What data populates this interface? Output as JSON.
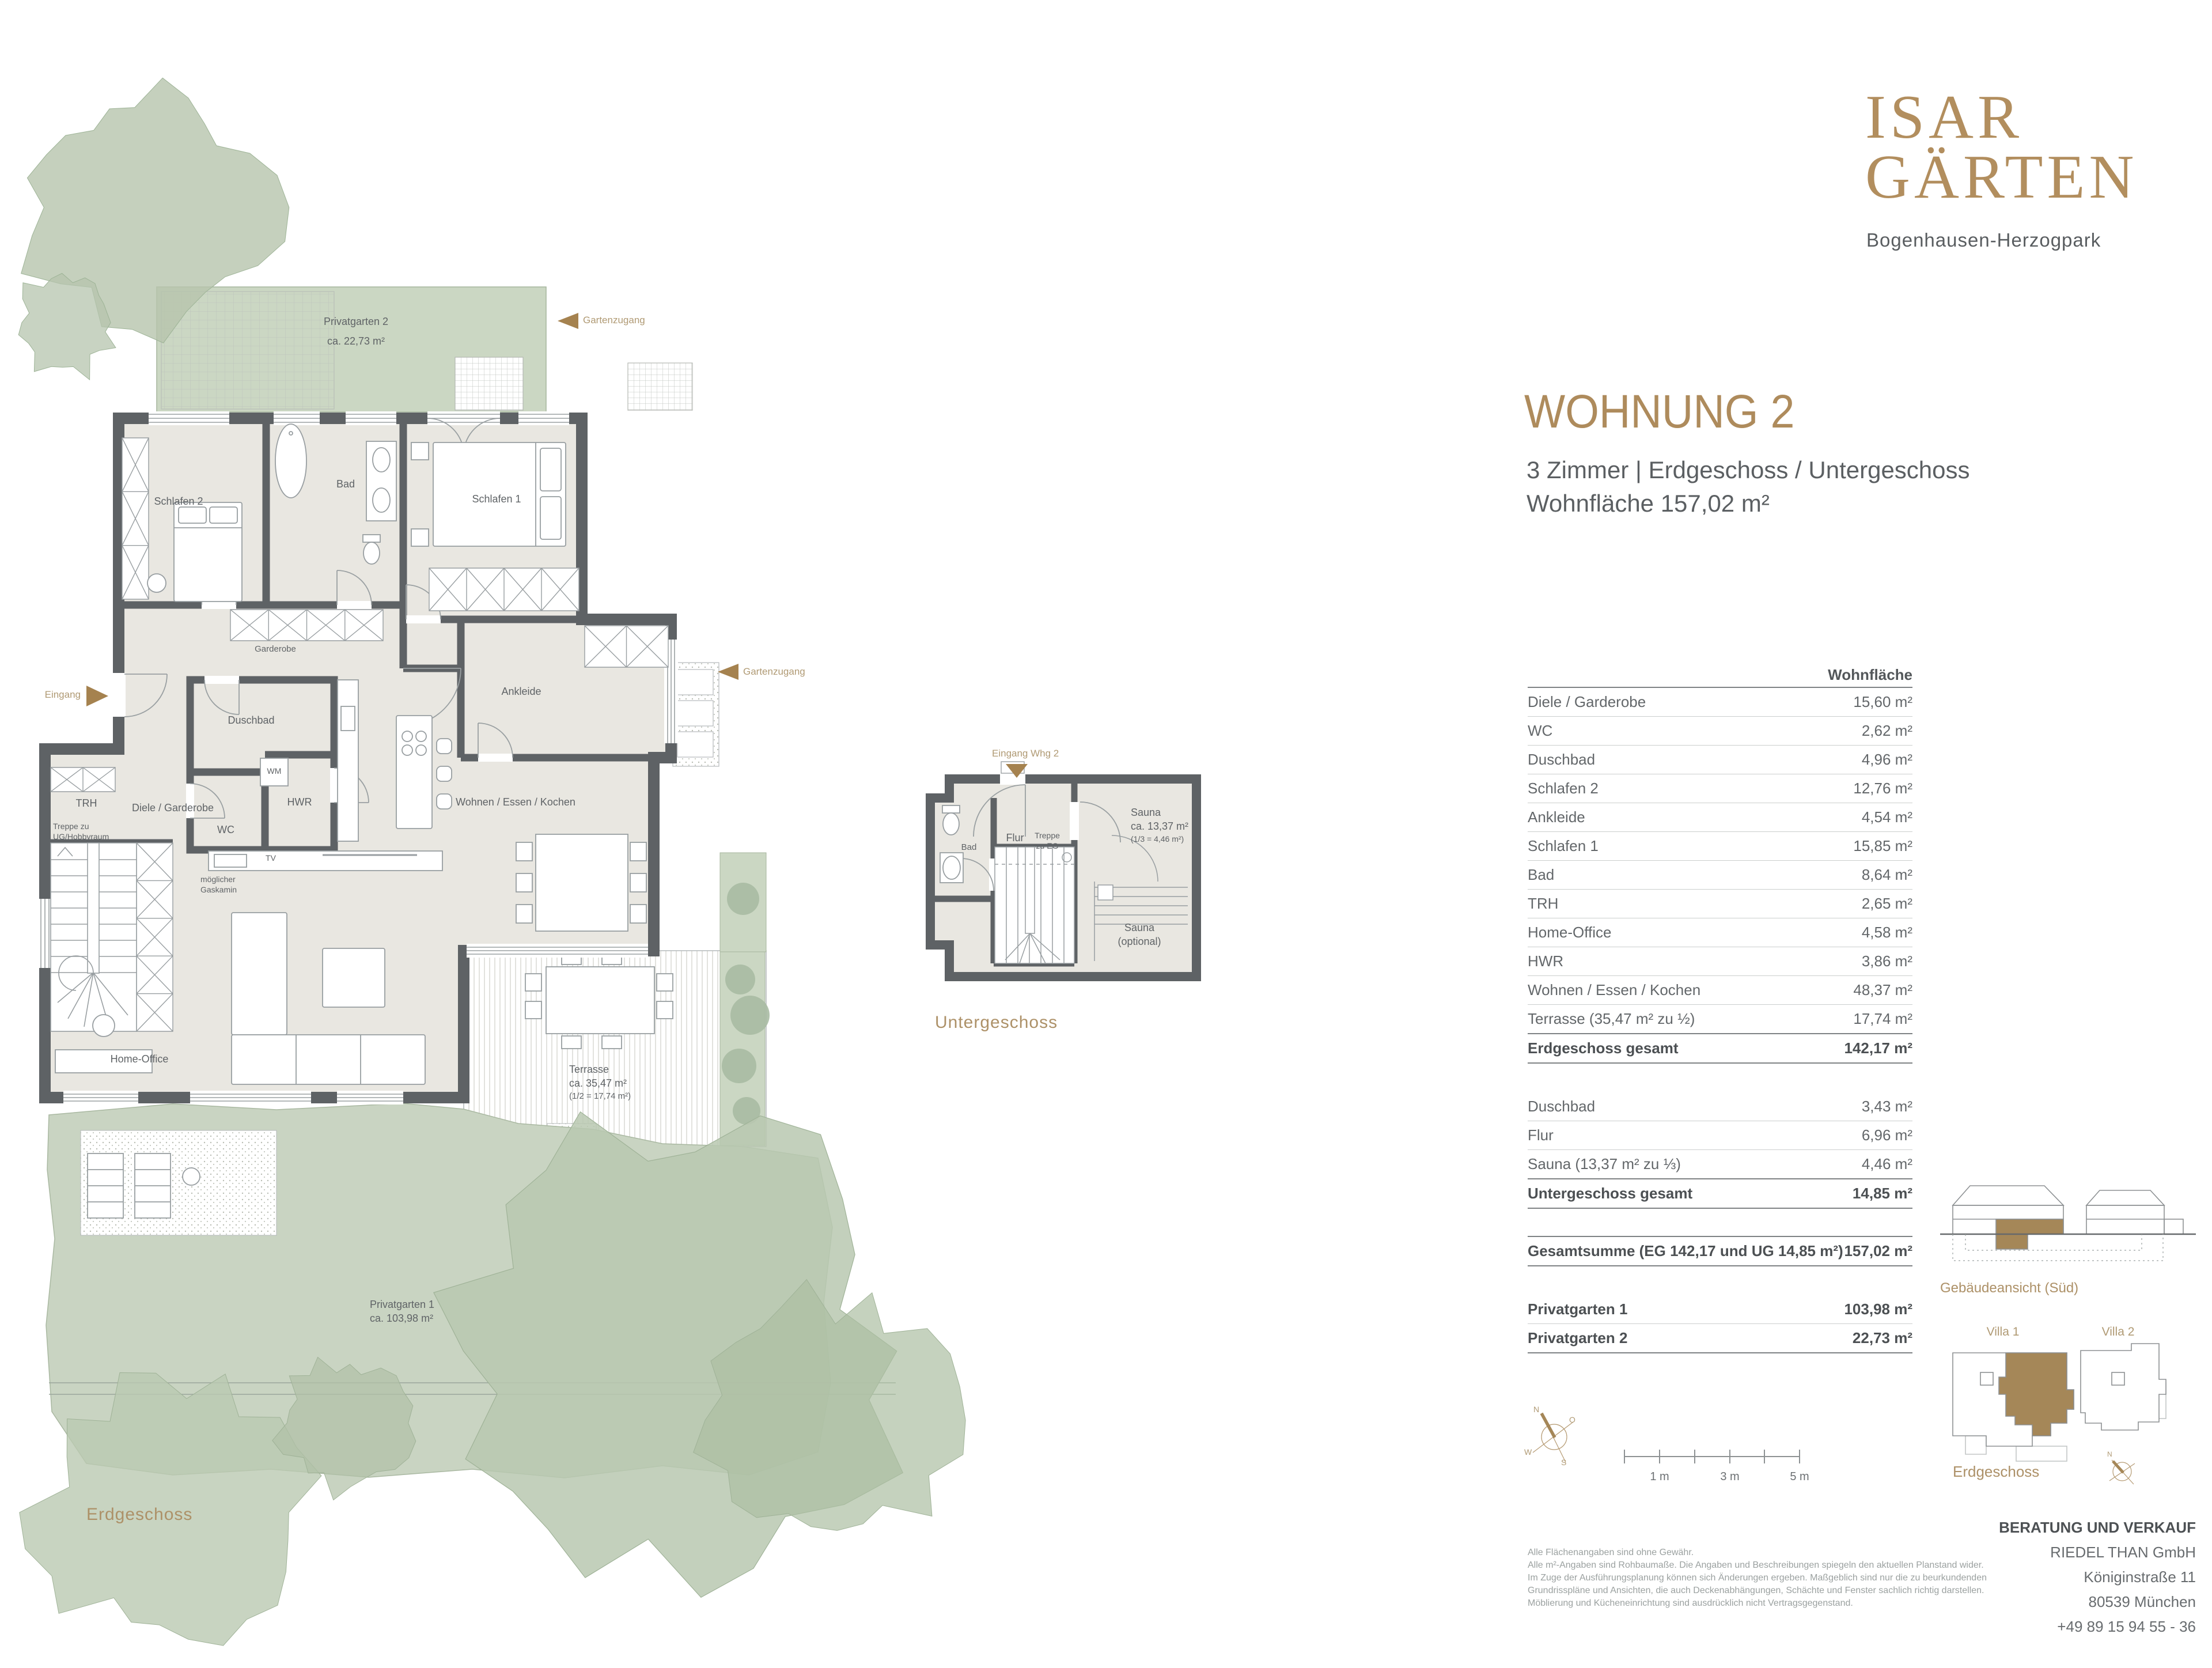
{
  "logo": {
    "line1": "ISAR",
    "line2": "GÄRTEN",
    "subtitle": "Bogenhausen-Herzogpark"
  },
  "header": {
    "title": "WOHNUNG 2",
    "line1": "3 Zimmer | Erdgeschoss / Untergeschoss",
    "line2": "Wohnfläche 157,02 m²"
  },
  "area_table": {
    "column_header": "Wohnfläche",
    "eg_rows": [
      {
        "label": "Diele / Garderobe",
        "value": "15,60 m²"
      },
      {
        "label": "WC",
        "value": "2,62 m²"
      },
      {
        "label": "Duschbad",
        "value": "4,96 m²"
      },
      {
        "label": "Schlafen 2",
        "value": "12,76 m²"
      },
      {
        "label": "Ankleide",
        "value": "4,54 m²"
      },
      {
        "label": "Schlafen 1",
        "value": "15,85 m²"
      },
      {
        "label": "Bad",
        "value": "8,64 m²"
      },
      {
        "label": "TRH",
        "value": "2,65 m²"
      },
      {
        "label": "Home-Office",
        "value": "4,58 m²"
      },
      {
        "label": "HWR",
        "value": "3,86 m²"
      },
      {
        "label": "Wohnen / Essen / Kochen",
        "value": "48,37 m²"
      },
      {
        "label": "Terrasse (35,47 m² zu ½)",
        "value": "17,74 m²"
      },
      {
        "label": "Erdgeschoss gesamt",
        "value": "142,17 m²",
        "cls": "total"
      }
    ],
    "ug_rows": [
      {
        "label": "Duschbad",
        "value": "3,43 m²"
      },
      {
        "label": "Flur",
        "value": "6,96 m²"
      },
      {
        "label": "Sauna (13,37 m² zu ⅓)",
        "value": "4,46 m²"
      },
      {
        "label": "Untergeschoss gesamt",
        "value": "14,85 m²",
        "cls": "total"
      }
    ],
    "sum_rows": [
      {
        "label": "Gesamtsumme  (EG 142,17 und UG 14,85 m²)",
        "value": "157,02 m²",
        "cls": "total"
      }
    ],
    "garden_rows": [
      {
        "label": "Privatgarten 1",
        "value": "103,98 m²",
        "cls": "bold"
      },
      {
        "label": "Privatgarten 2",
        "value": "22,73 m²",
        "cls": "bold"
      }
    ]
  },
  "eg": {
    "privatgarten2_1": "Privatgarten 2",
    "privatgarten2_2": "ca. 22,73 m²",
    "gartenzugang_top": "Gartenzugang",
    "gartenzugang_mid": "Gartenzugang",
    "schlafen2": "Schlafen 2",
    "bad": "Bad",
    "schlafen1": "Schlafen 1",
    "garderobe": "Garderobe",
    "ankleide": "Ankleide",
    "eingang": "Eingang",
    "duschbad": "Duschbad",
    "wm": "WM",
    "trh": "TRH",
    "diele": "Diele / Garderobe",
    "hwr": "HWR",
    "wc": "WC",
    "treppe_1": "Treppe zu",
    "treppe_2": "UG/Hobbyraum",
    "tv": "TV",
    "gaskamin_1": "möglicher",
    "gaskamin_2": "Gaskamin",
    "wohnen": "Wohnen / Essen / Kochen",
    "homeoffice": "Home-Office",
    "terrasse_1": "Terrasse",
    "terrasse_2": "ca. 35,47 m²",
    "terrasse_3": "(1/2 = 17,74 m²)",
    "privatgarten1_1": "Privatgarten 1",
    "privatgarten1_2": "ca. 103,98 m²",
    "caption": "Erdgeschoss"
  },
  "ug": {
    "eingang": "Eingang Whg 2",
    "bad": "Bad",
    "flur": "Flur",
    "treppe_1": "Treppe",
    "treppe_2": "zu EG",
    "sauna_1": "Sauna",
    "sauna_2": "ca. 13,37 m²",
    "sauna_3": "(1/3 = 4,46 m²)",
    "saunaopt_1": "Sauna",
    "saunaopt_2": "(optional)",
    "caption": "Untergeschoss"
  },
  "elevation": {
    "caption": "Gebäudeansicht (Süd)"
  },
  "site": {
    "villa1": "Villa 1",
    "villa2": "Villa 2",
    "caption": "Erdgeschoss",
    "north": "N"
  },
  "compass": {
    "n": "N",
    "o": "O",
    "w": "W",
    "s": "S"
  },
  "scalebar": {
    "m1": "1 m",
    "m3": "3 m",
    "m5": "5 m"
  },
  "contact": {
    "heading": "BERATUNG UND VERKAUF",
    "company": "RIEDEL THAN GmbH",
    "street": "Königinstraße 11",
    "city": "80539 München",
    "phone": "+49 89 15 94 55 - 36"
  },
  "disclaimer": {
    "lines": [
      "Alle Flächenangaben sind ohne Gewähr.",
      "Alle m²-Angaben sind Rohbaumaße. Die Angaben und Beschreibungen spiegeln den aktuellen Planstand wider.",
      "Im Zuge der Ausführungsplanung können sich Änderungen ergeben. Maßgeblich sind nur die zu beurkundenden",
      "Grundrisspläne und Ansichten, die auch Deckenabhängungen, Schächte und Fenster sachlich richtig darstellen.",
      "Möblierung und Kücheneinrichtung sind ausdrücklich nicht Vertragsgegenstand."
    ]
  },
  "colors": {
    "bronze": "#ab8a5c",
    "wall": "#5e6265",
    "garden": "#cbd7c3",
    "unit_highlight": "#a58758"
  }
}
